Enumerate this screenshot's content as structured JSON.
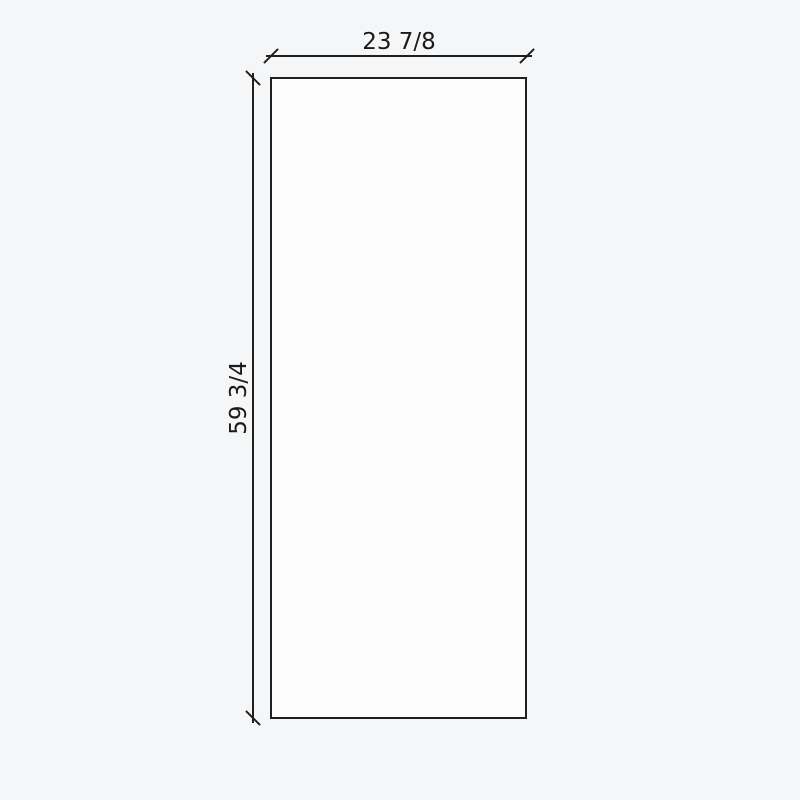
{
  "drawing": {
    "width_label": "23 7/8",
    "height_label": "59 3/4"
  },
  "colors": {
    "background": "#f5f6f7",
    "panel_fill": "#fdfdfd",
    "line": "#1f1f1f",
    "text": "#1a1a1a"
  }
}
